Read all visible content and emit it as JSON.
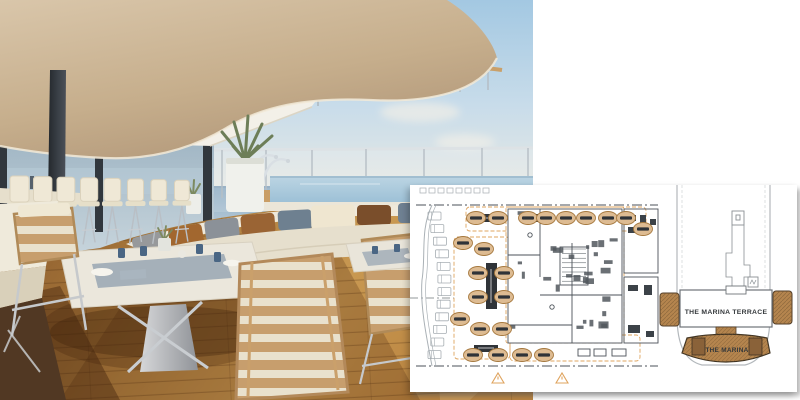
{
  "plan": {
    "terrace_label": "THE MARINA TERRACE",
    "marina_label": "THE MARINA",
    "colors": {
      "table_fill": "#ddbb92",
      "table_stroke": "#a6793f",
      "table_bar": "#2f3338",
      "marina_brown": "#b5854e",
      "marina_dark": "#8a6239",
      "accent_orange": "#dfa45f",
      "line_gray": "#4b5258",
      "light_gray": "#a7aeb3"
    },
    "dining_tables": [
      [
        66,
        33
      ],
      [
        88,
        33
      ],
      [
        118,
        33
      ],
      [
        136,
        33
      ],
      [
        156,
        33
      ],
      [
        176,
        33
      ],
      [
        198,
        33
      ],
      [
        216,
        33
      ],
      [
        233,
        44
      ],
      [
        53,
        58
      ],
      [
        74,
        64
      ],
      [
        68,
        88
      ],
      [
        94,
        88
      ],
      [
        68,
        112
      ],
      [
        94,
        112
      ],
      [
        50,
        134
      ],
      [
        70,
        144
      ],
      [
        92,
        144
      ],
      [
        63,
        170
      ],
      [
        88,
        170
      ],
      [
        112,
        170
      ],
      [
        134,
        170
      ]
    ],
    "loungers": 12,
    "warning_triangles": [
      [
        88,
        198
      ],
      [
        152,
        198
      ]
    ]
  },
  "photo": {
    "colors": {
      "sky": "#a3c8e2",
      "ocean": "#8fadc4",
      "ceiling": "#d9c6aa",
      "deck_wood": "#b5803f",
      "sofa_cream": "#efe9da",
      "pool": "#b7d1e0",
      "pillar": "#2b2f35"
    },
    "bar_stools": 8,
    "cushion_colors": [
      "#97999b",
      "#a2672f",
      "#8b9198",
      "#9a6434",
      "#6e8090",
      "#efe6d0",
      "#7a4e2b",
      "#6f8192"
    ]
  }
}
